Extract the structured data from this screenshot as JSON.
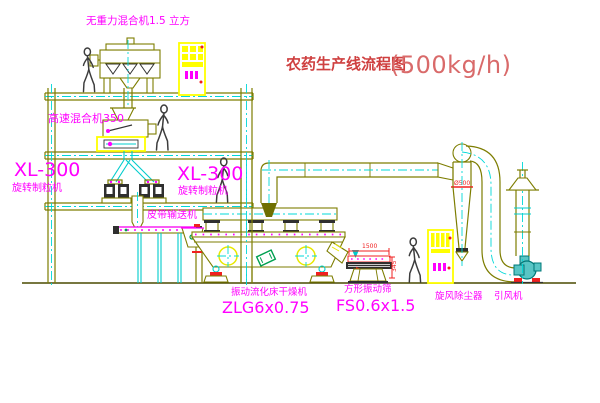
{
  "drawing": {
    "title_text": "农药生产线流程图",
    "title_capacity": "(500kg/h)"
  },
  "labels": {
    "gravity_mixer": "无重力混合机1.5 立方",
    "high_speed_mixer": "高速混合机350",
    "granulator_left": {
      "model": "XL-300",
      "name": "旋转制粒机"
    },
    "granulator_right": {
      "model": "XL-300",
      "name": "旋转制粒机"
    },
    "belt_conveyor": "皮带输送机",
    "fluid_bed_dryer": {
      "name": "振动流化床干燥机",
      "model": "ZLG6x0.75"
    },
    "square_sieve": {
      "name": "方形振动筛",
      "model": "FS0.6x1.5"
    },
    "cyclone": "旋风除尘器",
    "induced_draft_fan": "引风机"
  },
  "dimensions": {
    "cyclone_diameter": "Ø500",
    "sieve_length": "1500",
    "sieve_height": "345"
  },
  "colors": {
    "structure": "#7d7d00",
    "centerline": "#00d8d8",
    "label": "#ff00ff",
    "title": "#cf4040",
    "dimension": "#f02020",
    "cabinet": "#ffff00",
    "fan": "#2ab5b5"
  }
}
